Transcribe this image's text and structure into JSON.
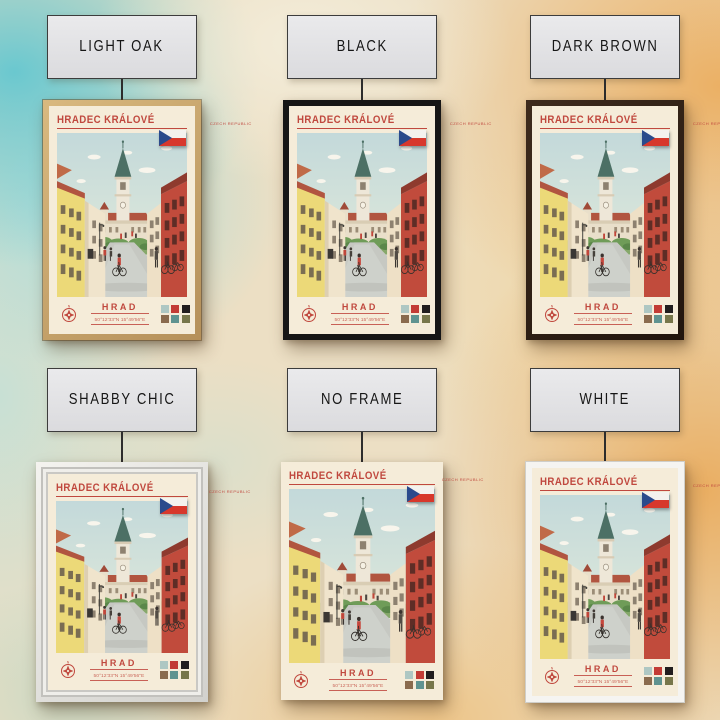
{
  "page": {
    "background_colors": {
      "base": "#ecdfc4",
      "teal_wash": "#60c6d0",
      "orange_wash": "#eba854",
      "cream_wash": "#f4eedc"
    }
  },
  "variants": [
    {
      "label": "LIGHT OAK",
      "frame": "light-oak",
      "frame_color": "#c9a56b"
    },
    {
      "label": "BLACK",
      "frame": "black",
      "frame_color": "#161616"
    },
    {
      "label": "DARK BROWN",
      "frame": "dark-brown",
      "frame_color": "#2f2013"
    },
    {
      "label": "SHABBY CHIC",
      "frame": "shabby-chic",
      "frame_color": "#e6e5e1"
    },
    {
      "label": "NO FRAME",
      "frame": "no-frame",
      "frame_color": ""
    },
    {
      "label": "WHITE",
      "frame": "white",
      "frame_color": "#f5f4f1"
    }
  ],
  "poster": {
    "title": "HRADEC KRÁLOVÉ",
    "country": "CZECH REPUBLIC",
    "landmark": "HRAD",
    "coordinates": "50°12'33\"N 15°49'56\"E",
    "flag": "czech-republic-flag",
    "accent": "#c0483e",
    "paper": "#f5ecd9",
    "swatches": [
      "#aec7c3",
      "#c23b35",
      "#211d1e",
      "#8a6b4e",
      "#5f9390",
      "#77764a"
    ]
  }
}
